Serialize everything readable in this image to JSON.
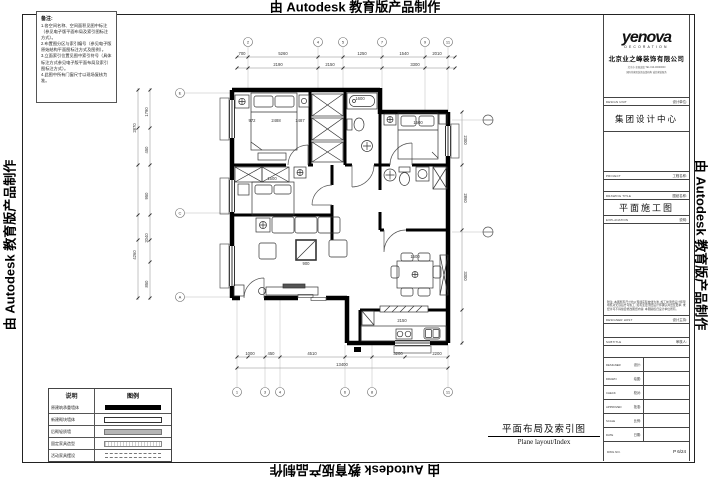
{
  "watermark": {
    "text": "由 Autodesk 教育版产品制作"
  },
  "notes_box": {
    "title": "备注:",
    "lines": [
      "1.各空间名称、空间面积见图中标注（参见电子版平面布局及索引图标注方式）。",
      "2.布置图分区与索引编号（参见电子版原始结构平面图标注方式及图例）。",
      "3.立面索引位置见图中索引符号（具体标注方式参见电子版平面布局及索引图标注方式）。",
      "4.此图中所有门窗尺寸以现场复核为准。"
    ]
  },
  "legend": {
    "headers": [
      "说明",
      "图例"
    ],
    "rows": [
      {
        "label": "原建筑承重墙体",
        "swatch": "solid-black"
      },
      {
        "label": "新建砌块墙体",
        "swatch": "outline"
      },
      {
        "label": "后砌轻质墙",
        "swatch": "gray"
      },
      {
        "label": "固定家具造型",
        "swatch": "dotted"
      },
      {
        "label": "活动家具摆设",
        "swatch": "dashed"
      }
    ]
  },
  "plan": {
    "title_cn": "平面布局及索引图",
    "title_en": "Plane layout/Index",
    "dims": [
      {
        "x": 242,
        "y": 55,
        "t": "700"
      },
      {
        "x": 283,
        "y": 55,
        "t": "5260"
      },
      {
        "x": 362,
        "y": 55,
        "t": "1250"
      },
      {
        "x": 404,
        "y": 55,
        "t": "1540"
      },
      {
        "x": 437,
        "y": 55,
        "t": "2010"
      },
      {
        "x": 278,
        "y": 66,
        "t": "2190"
      },
      {
        "x": 330,
        "y": 66,
        "t": "2150"
      },
      {
        "x": 415,
        "y": 66,
        "t": "3300"
      },
      {
        "x": 136,
        "y": 128,
        "t": "2870",
        "r": -90
      },
      {
        "x": 136,
        "y": 255,
        "t": "4260",
        "r": -90
      },
      {
        "x": 148,
        "y": 112,
        "t": "1790",
        "r": -90
      },
      {
        "x": 148,
        "y": 150,
        "t": "450",
        "r": -90
      },
      {
        "x": 148,
        "y": 196,
        "t": "950",
        "r": -90
      },
      {
        "x": 148,
        "y": 238,
        "t": "2040",
        "r": -90
      },
      {
        "x": 148,
        "y": 284,
        "t": "850",
        "r": -90
      },
      {
        "x": 250,
        "y": 355,
        "t": "1000"
      },
      {
        "x": 271,
        "y": 355,
        "t": "450"
      },
      {
        "x": 312,
        "y": 355,
        "t": "4510"
      },
      {
        "x": 398,
        "y": 355,
        "t": "3200"
      },
      {
        "x": 437,
        "y": 355,
        "t": "2200"
      },
      {
        "x": 342,
        "y": 366,
        "t": "13400"
      },
      {
        "x": 464,
        "y": 140,
        "t": "2300",
        "r": 90
      },
      {
        "x": 464,
        "y": 198,
        "t": "2860",
        "r": 90
      },
      {
        "x": 464,
        "y": 276,
        "t": "3300",
        "r": 90
      },
      {
        "x": 252,
        "y": 122,
        "t": "972"
      },
      {
        "x": 276,
        "y": 122,
        "t": "2488"
      },
      {
        "x": 300,
        "y": 122,
        "t": "1487"
      },
      {
        "x": 418,
        "y": 124,
        "t": "1500"
      },
      {
        "x": 272,
        "y": 180,
        "t": "1500"
      },
      {
        "x": 306,
        "y": 265,
        "t": "900"
      },
      {
        "x": 415,
        "y": 258,
        "t": "1500"
      },
      {
        "x": 360,
        "y": 100,
        "t": "1600"
      },
      {
        "x": 402,
        "y": 322,
        "t": "2150"
      }
    ],
    "axes": {
      "top": [
        {
          "x": 248,
          "l": "2"
        },
        {
          "x": 318,
          "l": "4"
        },
        {
          "x": 343,
          "l": "5"
        },
        {
          "x": 382,
          "l": "7"
        },
        {
          "x": 425,
          "l": "9"
        },
        {
          "x": 448,
          "l": "11"
        }
      ],
      "bottom": [
        {
          "x": 237,
          "l": "1"
        },
        {
          "x": 265,
          "l": "3"
        },
        {
          "x": 280,
          "l": "4"
        },
        {
          "x": 345,
          "l": "6"
        },
        {
          "x": 372,
          "l": "8"
        },
        {
          "x": 448,
          "l": "11"
        }
      ],
      "left": [
        {
          "y": 93,
          "l": "E"
        },
        {
          "y": 213,
          "l": "C"
        },
        {
          "y": 297,
          "l": "A"
        }
      ]
    }
  },
  "title_block": {
    "logo": "yenova",
    "logo_sub": "DECORATION",
    "company": "北京业之峰装饰有限公司",
    "addr1": "北京市·全国连锁 TEL:010-00000000",
    "addr2": "国际化家居装饰连锁机构 诚信家装服务",
    "design_unit_en": "DESIGN UNIT",
    "design_unit_cn": "设计单位:",
    "design_unit_value": "集团设计中心",
    "project_en": "PROJECT",
    "project_cn": "工程名称:",
    "drawing_title_en": "DRAWING TITLE",
    "drawing_title_cn": "图纸名称:",
    "drawing_title_value": "平面施工图",
    "explanation_en": "EXPLANATION",
    "explanation_cn": "说明:",
    "notes": "附注: 本图所有尺寸均以现场实际放线为准, 施工前须经设计师现场核对无误后方可施工; 如有变更须经设计师确认并出变更单; 未经许可不得擅自修改图纸内容, 本图版权归设计单位所有。",
    "designer_host_en": "DESIGNER HOST",
    "designer_host_cn": "设计主持:",
    "subtitle_en": "SUBTITLE",
    "subtitle_cn": "审核人:",
    "rows": [
      {
        "en": "DESIGNER",
        "cn": "设计:"
      },
      {
        "en": "DRAWN",
        "cn": "绘图:"
      },
      {
        "en": "CHECK",
        "cn": "校对:"
      },
      {
        "en": "APPROVED",
        "cn": "批准:"
      },
      {
        "en": "SCALE",
        "cn": "比例:"
      },
      {
        "en": "DATE",
        "cn": "日期:"
      }
    ],
    "dwg_no_en": "DWG NO.",
    "page_value": "P 6/24"
  }
}
